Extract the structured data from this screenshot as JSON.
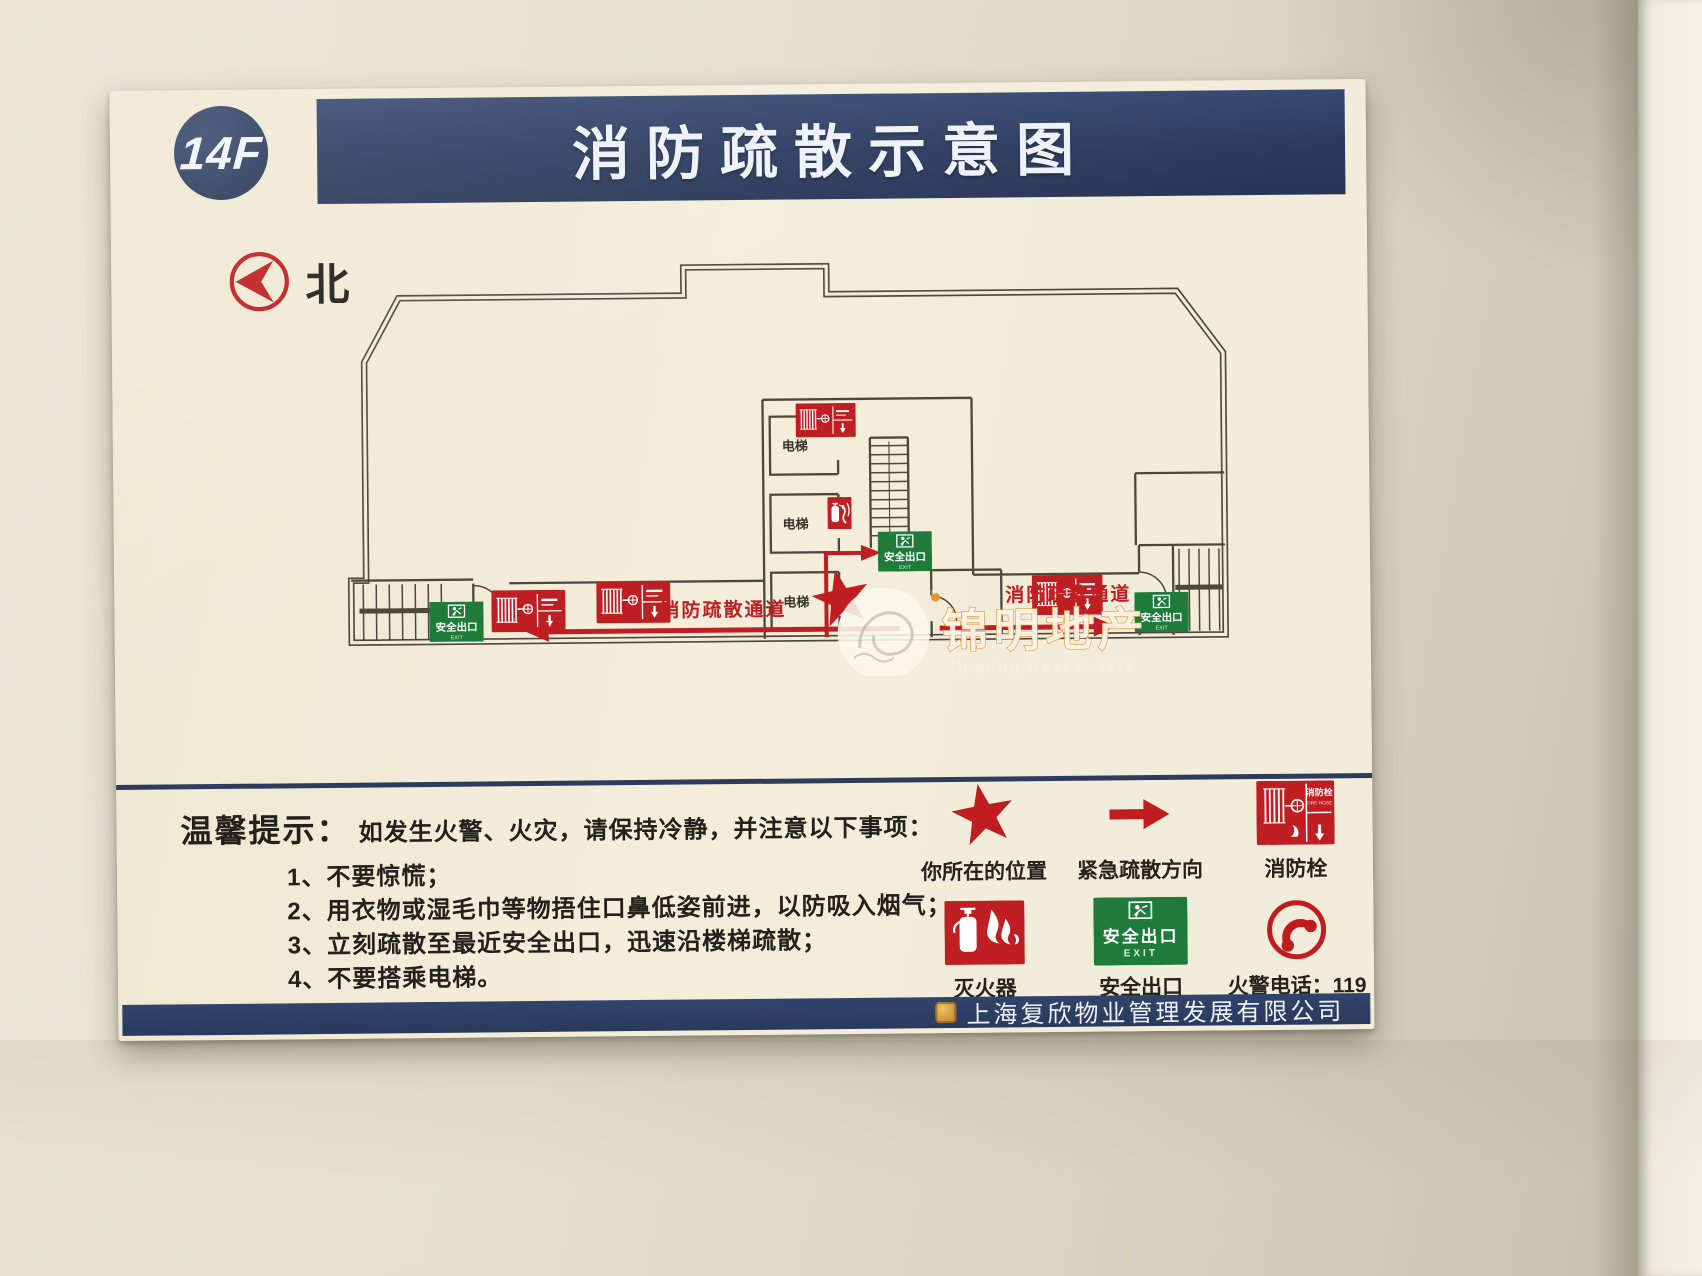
{
  "board": {
    "floor_label": "14F",
    "title": "消防疏散示意图",
    "north_label": "北"
  },
  "plan": {
    "elevator_label": "电梯",
    "corridor_label": "消防疏散通道",
    "exit_sign": {
      "line1": "安全出口",
      "line2": "EXIT"
    },
    "hydrant_sign": {
      "line1": "消防栓",
      "line2": "FIRE HOSE"
    },
    "watermark": {
      "name": "锦明地产",
      "sub": "Jinming Real Estate",
      "reg": "®"
    }
  },
  "tips": {
    "heading": "温馨提示：",
    "intro": "如发生火警、火灾，请保持冷静，并注意以下事项：",
    "items": [
      "1、不要惊慌；",
      "2、用衣物或湿毛巾等物捂住口鼻低姿前进，以防吸入烟气；",
      "3、立刻疏散至最近安全出口，迅速沿楼梯疏散；",
      "4、不要搭乘电梯。"
    ]
  },
  "legend": {
    "items": [
      {
        "name": "you-are-here",
        "label": "你所在的位置"
      },
      {
        "name": "evacuation-direction",
        "label": "紧急疏散方向"
      },
      {
        "name": "fire-hydrant",
        "label": "消防栓"
      },
      {
        "name": "fire-extinguisher",
        "label": "灭火器"
      },
      {
        "name": "safety-exit",
        "label": "安全出口"
      },
      {
        "name": "fire-phone",
        "label": "火警电话：119"
      }
    ]
  },
  "footer": {
    "company": "上海复欣物业管理发展有限公司"
  },
  "colors": {
    "header_blue": "#2d3f66",
    "sign_red": "#bf1e22",
    "exit_green": "#1e7b3a",
    "wall_line": "#4d483a",
    "board_cream": "#f2ecd9"
  }
}
